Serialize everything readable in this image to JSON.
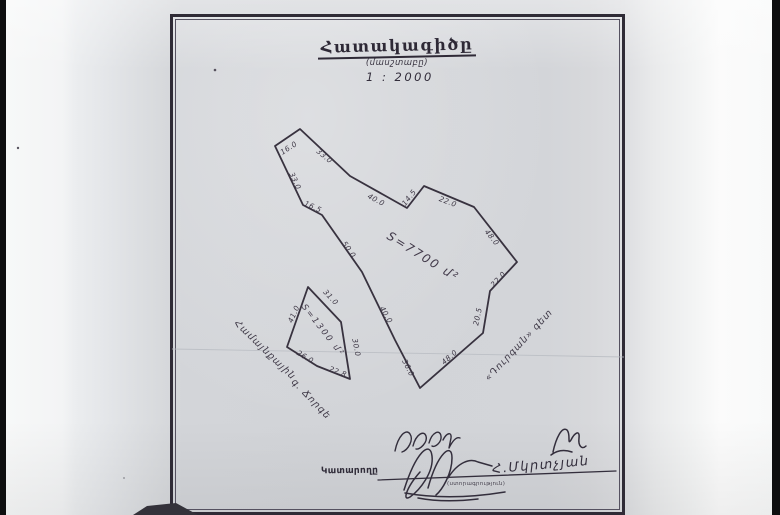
{
  "document": {
    "title": "Հատակագիծը",
    "subtitle": "(մասշտաբը)",
    "scale": "1 : 2000",
    "executor": {
      "label": "Կատարողը",
      "signature_note": "(ստորագրություն)",
      "signed_name": "Հ.Մկրտչյան"
    }
  },
  "plan": {
    "ink_color": "#38323f",
    "paper_color": "#d3d5d9",
    "frame_color": "#2f2b36",
    "parcels": [
      {
        "id": "parcel-large",
        "area_label": "S=7700 մ²",
        "area_pos": {
          "x": 421,
          "y": 260,
          "rot": 32,
          "size": 12
        },
        "vertices": [
          [
            300,
            129
          ],
          [
            350,
            176
          ],
          [
            407,
            208
          ],
          [
            424,
            186
          ],
          [
            474,
            207
          ],
          [
            517,
            262
          ],
          [
            490,
            291
          ],
          [
            483,
            333
          ],
          [
            420,
            388
          ],
          [
            395,
            340
          ],
          [
            362,
            272
          ],
          [
            322,
            215
          ],
          [
            303,
            205
          ],
          [
            275,
            146
          ]
        ],
        "edges": [
          {
            "text": "16.0",
            "x": 290,
            "y": 150,
            "rot": -33
          },
          {
            "text": "33.0",
            "x": 323,
            "y": 158,
            "rot": 40
          },
          {
            "text": "40.0",
            "x": 375,
            "y": 202,
            "rot": 28
          },
          {
            "text": "14.5",
            "x": 411,
            "y": 199,
            "rot": -52
          },
          {
            "text": "22.0",
            "x": 447,
            "y": 204,
            "rot": 21
          },
          {
            "text": "48.0",
            "x": 490,
            "y": 239,
            "rot": 51
          },
          {
            "text": "22.0",
            "x": 500,
            "y": 281,
            "rot": -47
          },
          {
            "text": "20.5",
            "x": 480,
            "y": 317,
            "rot": -78
          },
          {
            "text": "48.0",
            "x": 451,
            "y": 359,
            "rot": -41
          },
          {
            "text": "36.0",
            "x": 406,
            "y": 369,
            "rot": 63
          },
          {
            "text": "40.0",
            "x": 384,
            "y": 316,
            "rot": 60
          },
          {
            "text": "50.0",
            "x": 347,
            "y": 251,
            "rot": 55
          },
          {
            "text": "16.5",
            "x": 312,
            "y": 209,
            "rot": 24
          },
          {
            "text": "33.0",
            "x": 293,
            "y": 182,
            "rot": 65
          }
        ]
      },
      {
        "id": "parcel-small",
        "area_label": "S=1300 մ²",
        "area_pos": {
          "x": 321,
          "y": 332,
          "rot": 52,
          "size": 8.5
        },
        "vertices": [
          [
            308,
            287
          ],
          [
            341,
            322
          ],
          [
            350,
            379
          ],
          [
            317,
            366
          ],
          [
            287,
            347
          ]
        ],
        "edges": [
          {
            "text": "31.0",
            "x": 329,
            "y": 299,
            "rot": 47
          },
          {
            "text": "30.0",
            "x": 354,
            "y": 348,
            "rot": 79
          },
          {
            "text": "22.8",
            "x": 337,
            "y": 374,
            "rot": 21
          },
          {
            "text": "26.0",
            "x": 304,
            "y": 359,
            "rot": 31
          },
          {
            "text": "41.0",
            "x": 296,
            "y": 315,
            "rot": -66
          }
        ]
      }
    ],
    "annotations": [
      {
        "text": "Համայնքային",
        "x": 263,
        "y": 352,
        "rot": 44,
        "size": 9.5
      },
      {
        "text": "գ. Ճորգե",
        "x": 309,
        "y": 401,
        "rot": 46,
        "size": 9.5
      },
      {
        "text": "«Դուրգան» գետ",
        "x": 521,
        "y": 347,
        "rot": -47,
        "size": 9.5
      }
    ]
  }
}
